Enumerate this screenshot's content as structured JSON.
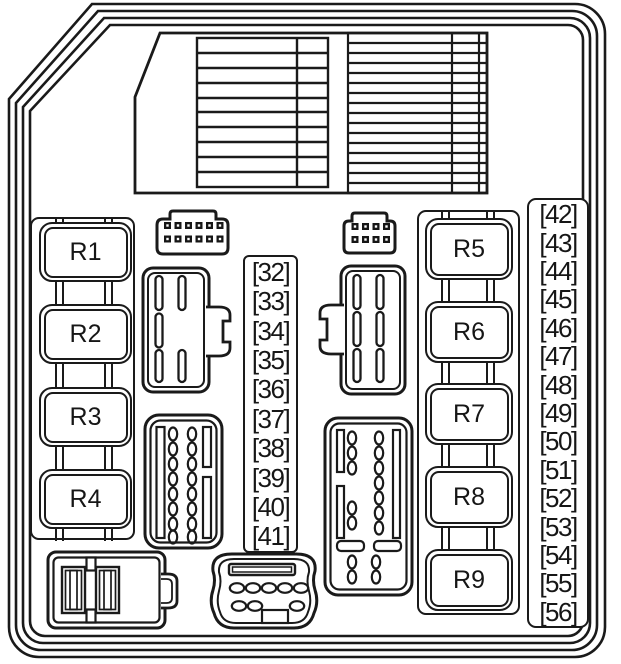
{
  "colors": {
    "line": "#1a1a1a",
    "background": "#ffffff"
  },
  "relays": {
    "left": [
      {
        "label": "R1"
      },
      {
        "label": "R2"
      },
      {
        "label": "R3"
      },
      {
        "label": "R4"
      }
    ],
    "right": [
      {
        "label": "R5"
      },
      {
        "label": "R6"
      },
      {
        "label": "R7"
      },
      {
        "label": "R8"
      },
      {
        "label": "R9"
      }
    ]
  },
  "fuse_strips": {
    "middle": {
      "items": [
        "[32]",
        "[33]",
        "[34]",
        "[35]",
        "[36]",
        "[37]",
        "[38]",
        "[39]",
        "[40]",
        "[41]"
      ]
    },
    "right": {
      "items": [
        "[42]",
        "[43]",
        "[44]",
        "[45]",
        "[46]",
        "[47]",
        "[48]",
        "[49]",
        "[50]",
        "[51]",
        "[52]",
        "[53]",
        "[54]",
        "[55]",
        "[56]"
      ]
    }
  }
}
